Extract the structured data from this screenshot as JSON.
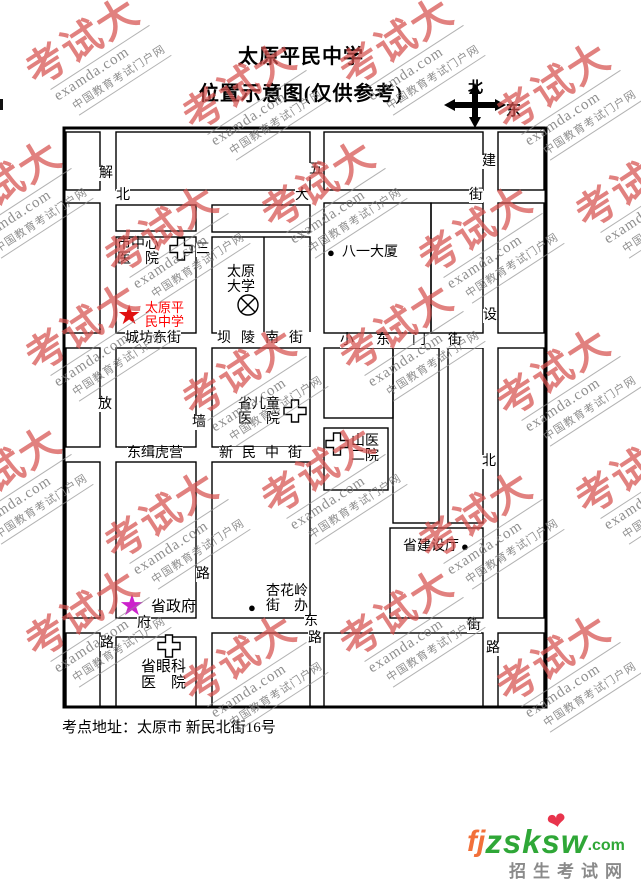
{
  "title": {
    "line1": "太原平民中学",
    "line2": "位置示意图(仅供参考)"
  },
  "compass": {
    "north_label": "北",
    "east_label": "东"
  },
  "watermark": {
    "brand": "考试大",
    "domain": "examda.com",
    "tagline": "中国教育考试门户网",
    "brand_color": "#d6504d",
    "text_color": "#7a7a7a"
  },
  "map": {
    "streets": {
      "beidajie": {
        "bei": "北",
        "da": "大",
        "jie": "街"
      },
      "chengfang_dongjie": "城坊东街",
      "baling_nanjie": "坝陵南街",
      "xiaodongmen_jie": "小东门街",
      "dongjihuying": "东缉虎营",
      "xinmin_zhongjie": "新民中街",
      "fudongjie": {
        "fu": "府",
        "dong": "东",
        "jie": "街"
      },
      "jiefang_lu": {
        "c1": "解",
        "c2": "放",
        "c3": "路"
      },
      "sanqiang_lu": {
        "c1": "三",
        "c2": "墙",
        "c3": "路"
      },
      "wuyi_lu": {
        "c1": "五",
        "c2": "路"
      },
      "jianshe_beilu": {
        "c1": "建",
        "c2": "设",
        "c3": "北",
        "c4": "路"
      }
    },
    "places": {
      "city_central_hospital": {
        "line1": "市中心",
        "line2": "医　院"
      },
      "school": {
        "line1": "太原平",
        "line2": "民中学",
        "color": "#ff0000",
        "star": "★",
        "star_color": "#e01010"
      },
      "taiyuan_university": {
        "line1": "太原",
        "line2": "大学"
      },
      "bayi_building": {
        "label": "八一大厦",
        "dot": "●"
      },
      "children_hospital": {
        "line1": "省儿童",
        "line2": "医　院"
      },
      "shanyi_hospital": {
        "line1": "山医",
        "line2": "二院"
      },
      "construction_dept": {
        "label": "省建设厅",
        "dot": "●"
      },
      "xinghualing_office": {
        "line1": "杏花岭",
        "line2": "街　办",
        "dot": "●"
      },
      "provincial_government": {
        "label": "省政府",
        "star": "★",
        "star_color": "#cc22cc"
      },
      "eye_hospital": {
        "line1": "省眼科",
        "line2": "医　院"
      }
    }
  },
  "footer": {
    "address": "考点地址：太原市 新民北街16号"
  },
  "logo": {
    "fj": "fj",
    "zsksw": "zsksw",
    "dotcom": ".com",
    "heart": "❤",
    "tagline": "招生考试网",
    "fj_color": "#f2703a",
    "green_color": "#2fa737",
    "tagline_color": "#8a8a8a",
    "heart_color": "#e8344c"
  }
}
